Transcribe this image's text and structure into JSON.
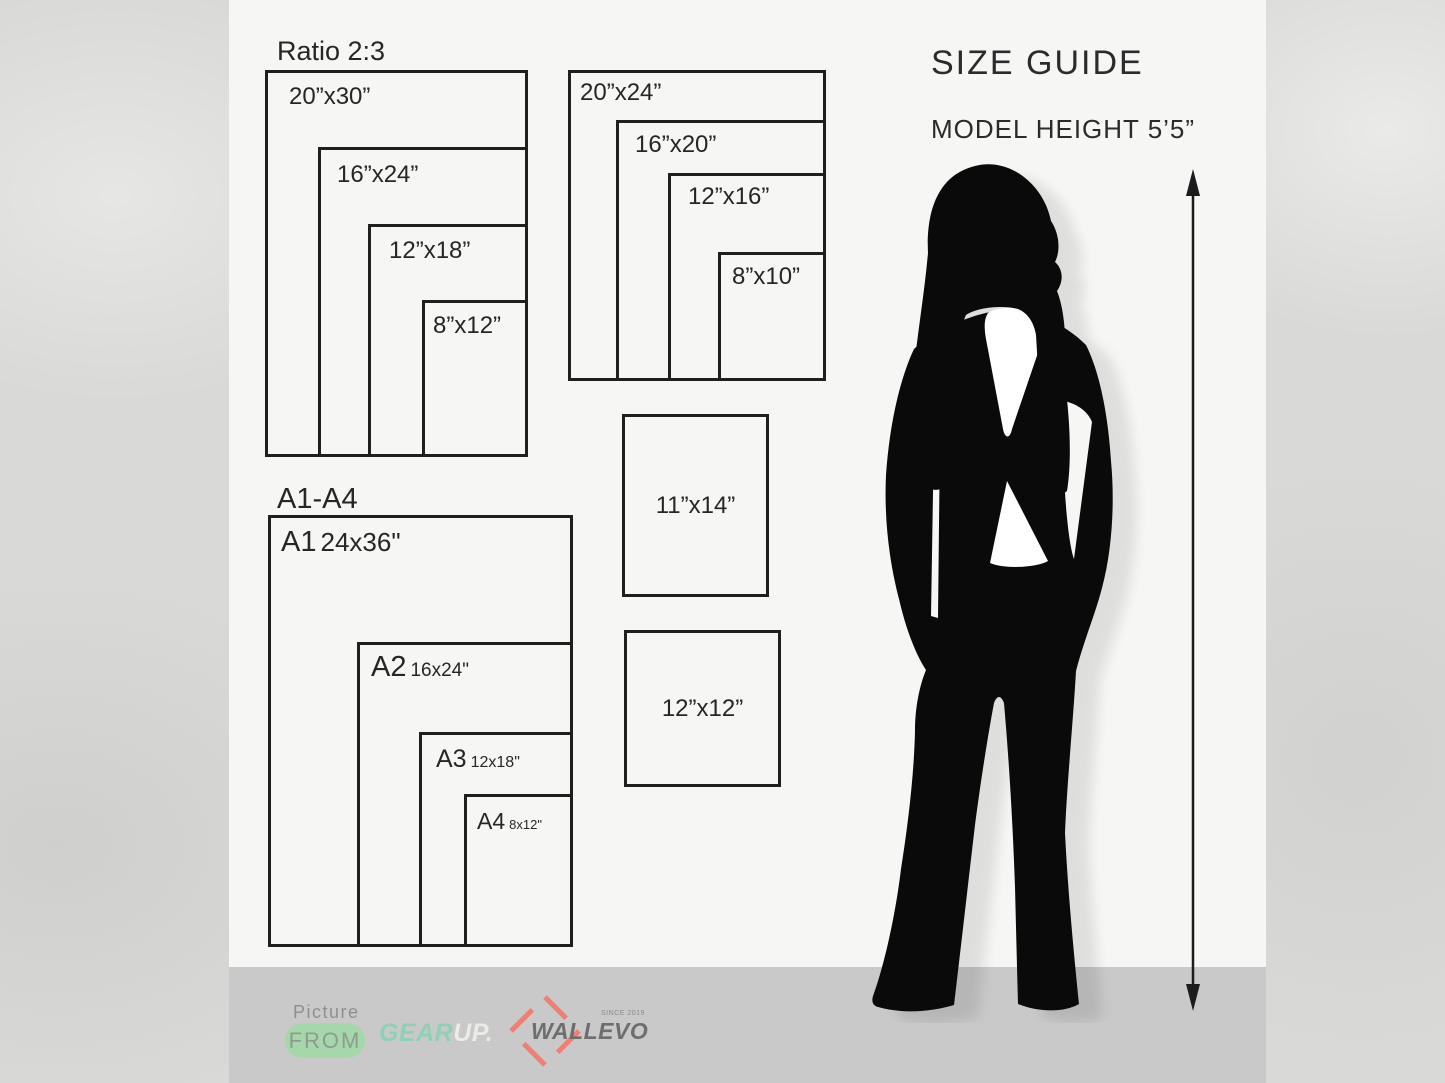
{
  "size_guide": {
    "title": "SIZE GUIDE",
    "model_height": "MODEL HEIGHT 5’5”"
  },
  "groups": {
    "ratio23": {
      "title": "Ratio 2:3",
      "sizes": [
        "20”x30”",
        "16”x24”",
        "12”x18”",
        "8”x12”"
      ]
    },
    "ratio45": {
      "sizes": [
        "20”x24”",
        "16”x20”",
        "12”x16”",
        "8”x10”"
      ]
    },
    "singles": [
      "11”x14”",
      "12”x12”"
    ],
    "a_series": {
      "title": "A1-A4",
      "sizes": [
        {
          "code": "A1",
          "size": "24x36\""
        },
        {
          "code": "A2",
          "size": "16x24\""
        },
        {
          "code": "A3",
          "size": "12x18\""
        },
        {
          "code": "A4",
          "size": "8x12\""
        }
      ]
    }
  },
  "footer": {
    "picture_label": "Picture",
    "from_label": "FROM",
    "gear": "GEAR",
    "up": "UP.",
    "wallevo": "WALLEVO",
    "since": "SINCE 2019"
  },
  "colors": {
    "card_bg": "#f6f6f4",
    "outer_bg": "#d9d9d7",
    "footer_band": "#c9c9c9",
    "line_black": "#1f1f1f",
    "accent_green": "#8ed1b5",
    "pill_green": "#a5d7ab",
    "wallevo_red": "#ee7f72",
    "silhouette_black": "#0a0a0a"
  }
}
